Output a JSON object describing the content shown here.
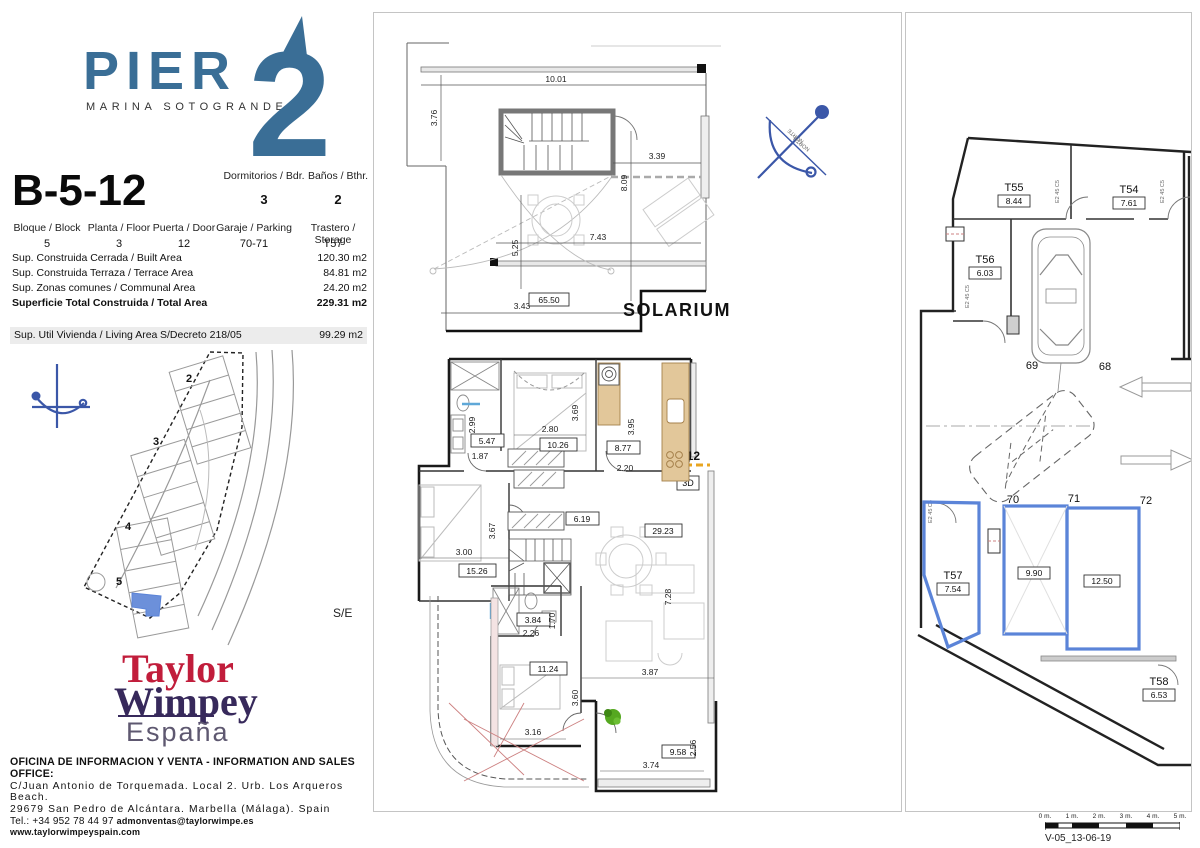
{
  "brand": {
    "pier": "PIER",
    "tagline": "MARINA SOTOGRANDE",
    "two": "2"
  },
  "unit": {
    "code": "B-5-12"
  },
  "specs": {
    "bedrooms_label": "Dormitorios / Bdr.",
    "bedrooms": "3",
    "baths_label": "Baños / Bthr.",
    "baths": "2",
    "block_label": "Bloque / Block",
    "block": "5",
    "floor_label": "Planta / Floor",
    "floor": "3",
    "door_label": "Puerta / Door",
    "door": "12",
    "parking_label": "Garaje / Parking",
    "parking": "70-71",
    "storage_label": "Trastero / Storage",
    "storage": "T57"
  },
  "areas": {
    "rows": [
      {
        "label": "Sup. Construida Cerrada / Built Area",
        "value": "120.30 m2"
      },
      {
        "label": "Sup. Construida Terraza / Terrace Area",
        "value": "84.81 m2"
      },
      {
        "label": "Sup. Zonas comunes / Communal Area",
        "value": "24.20 m2"
      },
      {
        "label": "Superficie Total Construida / Total Area",
        "value": "229.31 m2"
      }
    ],
    "living": {
      "label": "Sup. Util Vivienda / Living Area",
      "decree": "S/Decreto 218/05",
      "value": "99.29 m2"
    }
  },
  "siteplan": {
    "blocks": [
      "2",
      "3",
      "4",
      "5"
    ],
    "se": "S/E"
  },
  "developer": {
    "taylor": "Taylor",
    "wimpey": "Wimpey",
    "espana": "España"
  },
  "office": {
    "line1": "OFICINA DE INFORMACION Y VENTA  -  INFORMATION AND SALES OFFICE:",
    "line2": "C/Juan Antonio de Torquemada. Local 2. Urb. Los Arqueros Beach.",
    "line3": "29679 San Pedro de Alcántara. Marbella (Málaga). Spain",
    "tel": "Tel.: +34 952 78 44 97",
    "email": "admonventas@taylorwimpe.es",
    "web": "www.taylorwimpeyspain.com"
  },
  "solarium": {
    "title": "SOLARIUM",
    "area": "65.50",
    "dims": {
      "w": "10.01",
      "left": "3.76",
      "right": "3.39",
      "h": "8.09",
      "mid": "7.43",
      "midv": "5.25",
      "bottom": "3.43"
    }
  },
  "plan": {
    "entry": "5-12",
    "view3d": "3D",
    "rooms": {
      "bath1": "5.47",
      "bed2": "10.26",
      "kitchen": "8.77",
      "bed3": "15.26",
      "hall": "6.19",
      "living": "29.23",
      "bath2": "3.84",
      "bed1": "11.24",
      "terrace": "9.58"
    },
    "dims": {
      "d299": "2.99",
      "d280": "2.80",
      "d369": "3.69",
      "d395": "3.95",
      "d187": "1.87",
      "d220": "2.20",
      "d300": "3.00",
      "d367": "3.67",
      "d728": "7.28",
      "d360": "3.60",
      "d316": "3.16",
      "d226": "2.26",
      "d170": "1.70",
      "d387": "3.87",
      "d256": "2.56",
      "d374": "3.74"
    }
  },
  "garage": {
    "storages": [
      {
        "id": "T55",
        "area": "8.44"
      },
      {
        "id": "T54",
        "area": "7.61"
      },
      {
        "id": "T56",
        "area": "6.03"
      },
      {
        "id": "T57",
        "area": "7.54"
      },
      {
        "id": "T58",
        "area": "6.53"
      }
    ],
    "spots": {
      "s69": "69",
      "s68": "68",
      "s70": "70",
      "s71": "71",
      "s72": "72"
    },
    "spot_areas": {
      "p70": "9.90",
      "p71": "12.50"
    },
    "door_tag": "E2 45 C5"
  },
  "compass": {
    "norte": "NORTE",
    "north": "NORTH"
  },
  "scalebar": {
    "ticks": [
      "0 m.",
      "1 m.",
      "2 m.",
      "3 m.",
      "4 m.",
      "5 m."
    ],
    "version": "V-05_13-06-19"
  },
  "colors": {
    "pier_blue": "#3A6E96",
    "compass_blue": "#3B57A8",
    "highlight_blue": "#5B84D8",
    "taylor_red": "#C11D3B",
    "wimpey_purple": "#37295B",
    "tan": "#E2C79A",
    "green": "#55A820",
    "orange": "#E8A520",
    "red_hatch": "#CC8080"
  }
}
